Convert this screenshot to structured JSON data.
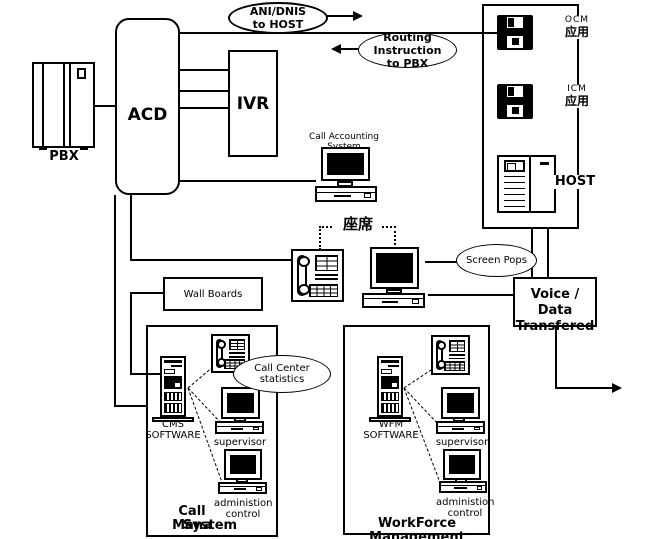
{
  "diagram": {
    "pbx": {
      "label": "PBX"
    },
    "acd": {
      "label": "ACD"
    },
    "ivr": {
      "label": "IVR"
    },
    "ani_dnis": {
      "line1": "ANI/DNIS",
      "line2": "to HOST"
    },
    "routing": {
      "line1": "Routing",
      "line2": "Instruction",
      "line3": "to PBX"
    },
    "host_panel": {
      "ocm_label": "OCM",
      "ocm_app": "应用",
      "icm_label": "ICM",
      "icm_app": "应用",
      "host_label": "HOST"
    },
    "call_accounting": {
      "label": "Call Accounting System"
    },
    "agent_seat": {
      "label": "座席"
    },
    "screen_pops": {
      "label": "Screen Pops"
    },
    "voice_data": {
      "line1": "Voice / Data",
      "line2": "Transfered"
    },
    "wall_boards": {
      "label": "Wall Boards"
    },
    "call_center_stats": {
      "line1": "Call Center",
      "line2": "statistics"
    },
    "cms": {
      "software_line1": "CMS",
      "software_line2": "SOFTWARE",
      "supervisor": "supervisor",
      "admin_line1": "administion",
      "admin_line2": "control",
      "title_line1": "Call Mana",
      "title_line2": "System"
    },
    "wfm": {
      "software_line1": "WFM",
      "software_line2": "SOFTWARE",
      "supervisor": "supervisor",
      "admin_line1": "administion",
      "admin_line2": "control",
      "title": "WorkForce Management"
    }
  }
}
